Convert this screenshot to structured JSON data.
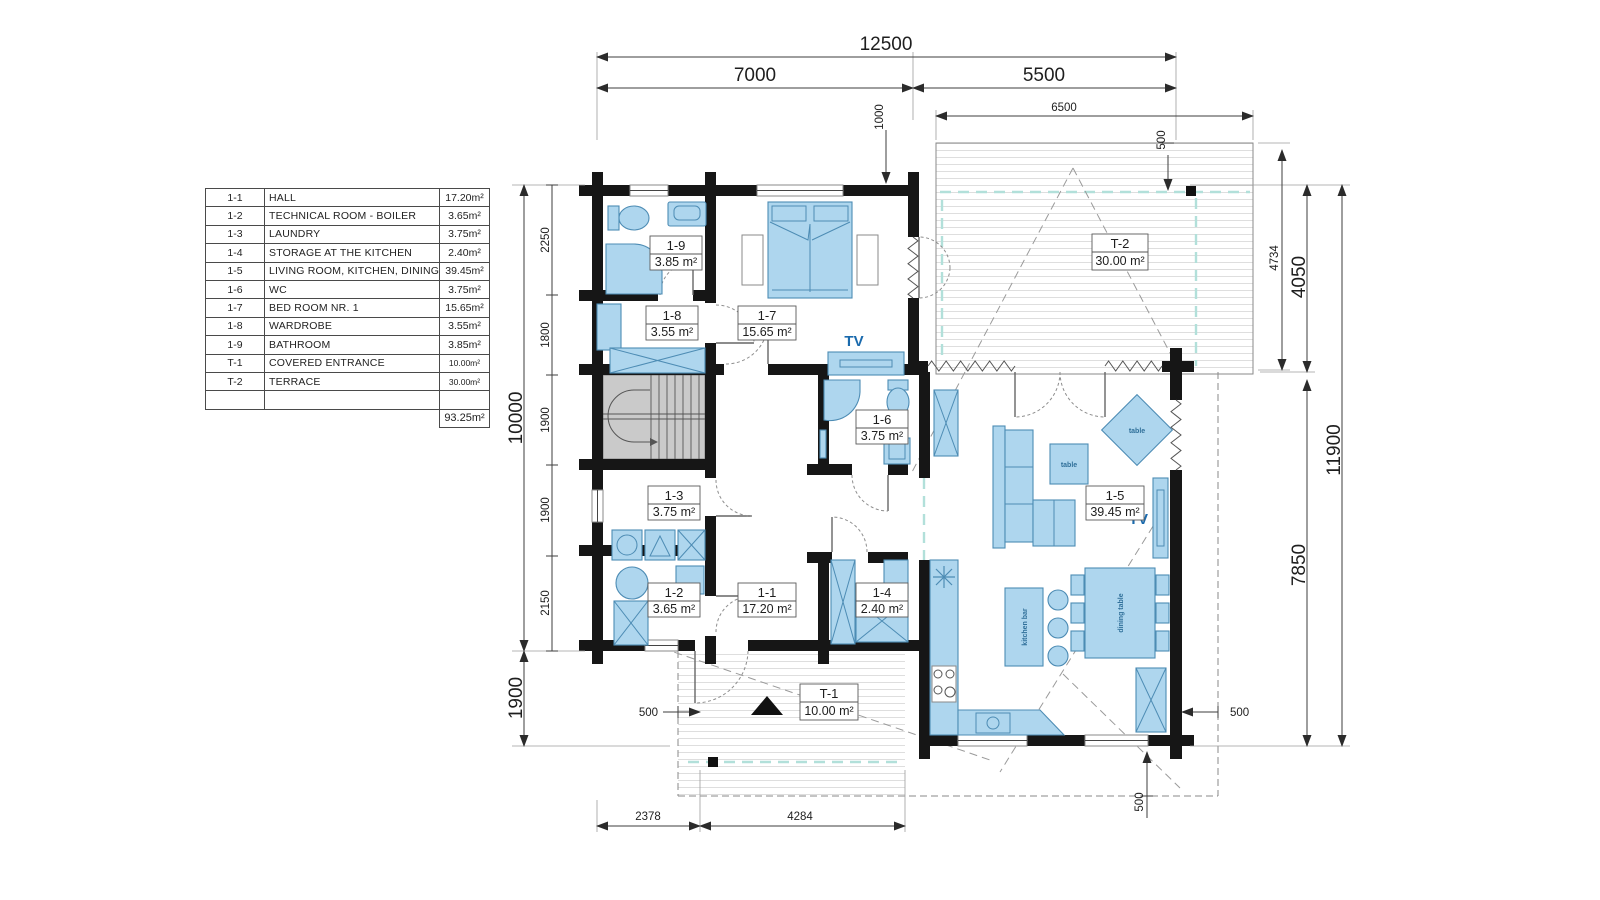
{
  "legend": {
    "rows": [
      {
        "code": "1-1",
        "name": "HALL",
        "area": "17.20m²"
      },
      {
        "code": "1-2",
        "name": "TECHNICAL ROOM - BOILER",
        "area": "3.65m²"
      },
      {
        "code": "1-3",
        "name": "LAUNDRY",
        "area": "3.75m²"
      },
      {
        "code": "1-4",
        "name": "STORAGE AT THE KITCHEN",
        "area": "2.40m²"
      },
      {
        "code": "1-5",
        "name": "LIVING ROOM, KITCHEN, DINING",
        "area": "39.45m²"
      },
      {
        "code": "1-6",
        "name": "WC",
        "area": "3.75m²"
      },
      {
        "code": "1-7",
        "name": "BED ROOM NR. 1",
        "area": "15.65m²"
      },
      {
        "code": "1-8",
        "name": "WARDROBE",
        "area": "3.55m²"
      },
      {
        "code": "1-9",
        "name": "BATHROOM",
        "area": "3.85m²"
      },
      {
        "code": "T-1",
        "name": "COVERED ENTRANCE",
        "area": "10.00m²"
      },
      {
        "code": "T-2",
        "name": "TERRACE",
        "area": "30.00m²"
      }
    ],
    "total_area": "93.25m²"
  },
  "room_labels": [
    {
      "code": "1-9",
      "area": "3.85 m²"
    },
    {
      "code": "1-8",
      "area": "3.55 m²"
    },
    {
      "code": "1-7",
      "area": "15.65 m²"
    },
    {
      "code": "1-6",
      "area": "3.75 m²"
    },
    {
      "code": "1-3",
      "area": "3.75 m²"
    },
    {
      "code": "1-2",
      "area": "3.65 m²"
    },
    {
      "code": "1-1",
      "area": "17.20 m²"
    },
    {
      "code": "1-4",
      "area": "2.40 m²"
    },
    {
      "code": "1-5",
      "area": "39.45 m²"
    },
    {
      "code": "T-1",
      "area": "10.00 m²"
    },
    {
      "code": "T-2",
      "area": "30.00 m²"
    }
  ],
  "dims": {
    "overall_width": "12500",
    "width_left": "7000",
    "width_right": "5500",
    "terrace_width": "6500",
    "terrace_offset": "1000",
    "terrace_inset": "500",
    "terrace_height": "4734",
    "right_upper": "4050",
    "right_lower": "7850",
    "right_total": "11900",
    "left_total": "10000",
    "left_segments": [
      "2250",
      "1800",
      "1900",
      "1900",
      "2150"
    ],
    "entrance_height": "1900",
    "bottom_left": "2378",
    "bottom_mid": "4284",
    "overhang_left": "500",
    "overhang_right": "500",
    "overhang_bottom": "500"
  },
  "annotations": {
    "tv": "TV",
    "table": "table",
    "kitchen_bar": "kitchen bar",
    "dining_table": "dining table"
  },
  "colors": {
    "furniture_fill": "#aed6ee",
    "furniture_stroke": "#4d8cb4",
    "wall": "#161616",
    "stairs_fill": "#cacaca",
    "accent_teal": "#b2e0da",
    "tv_text": "#1a6aad"
  }
}
